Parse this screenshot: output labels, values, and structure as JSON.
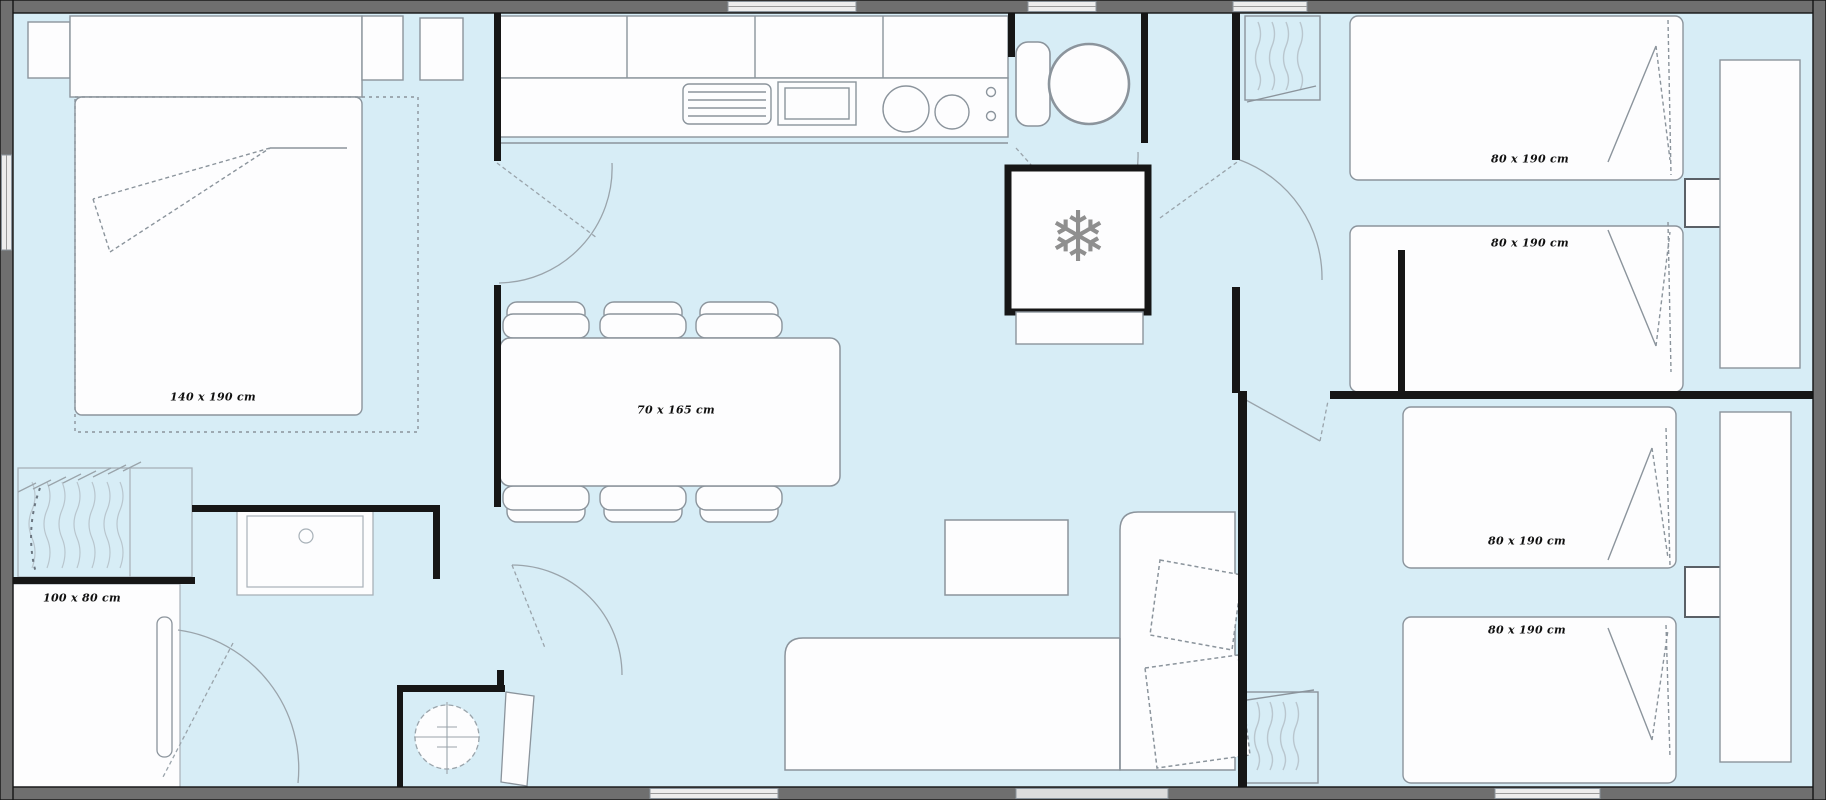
{
  "colors": {
    "floor": "#d7edf6",
    "wall_band": "#6f6f6f",
    "wall_edge": "#141414",
    "interior_wall": "#161616",
    "furniture_line": "#8b949c",
    "furniture_fill": "#fdfdfe",
    "window_fill": "#ededed",
    "label_text": "#101010",
    "snowflake": "#8f8f8f"
  },
  "labels": {
    "master_bed": {
      "text": "140 x 190 cm",
      "x": 213,
      "y": 397
    },
    "dining_table": {
      "text": "70 x 165 cm",
      "x": 676,
      "y": 410
    },
    "shower": {
      "text": "100 x 80 cm",
      "x": 82,
      "y": 598
    },
    "bed_1": {
      "text": "80 x 190 cm",
      "x": 1530,
      "y": 159
    },
    "bed_2": {
      "text": "80 x 190 cm",
      "x": 1530,
      "y": 243
    },
    "bed_3": {
      "text": "80 x 190 cm",
      "x": 1527,
      "y": 541
    },
    "bed_4": {
      "text": "80 x 190 cm",
      "x": 1527,
      "y": 630
    }
  },
  "icons": {
    "freezer": {
      "glyph": "❄",
      "color": "#8f8f8f"
    }
  }
}
